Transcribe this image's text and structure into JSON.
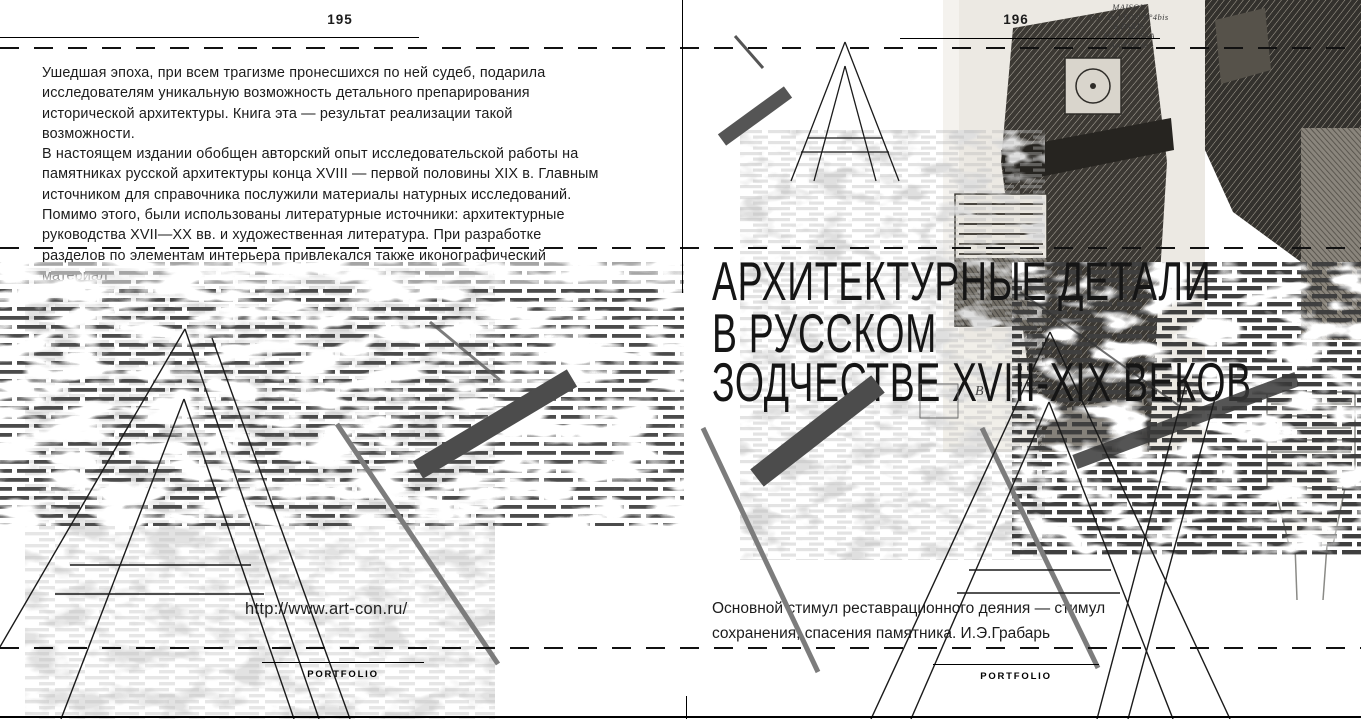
{
  "spread": {
    "left_page": {
      "page_number": "195",
      "paragraph": "Ушедшая эпоха, при всем трагизме пронесшихся по ней судеб, подарила\nисследователям уникальную возможность детального препарирования\nисторической архитектуры. Книга эта — результат реализации такой\nвозможности.\nВ настоящем издании обобщен авторский опыт исследовательской работы на\nпамятниках русской архитектуры конца XVIII — первой половины XIX в. Главным\nисточником для справочника послужили материалы натурных исследований.\nПомимо этого, были использованы литературные источники: архитектурные\nруководства XVII—XX вв. и художественная литература. При разработке\nразделов по элементам интерьера привлекался также иконографический\nматериал",
      "url": "http://www.art-con.ru/",
      "footer": "PORTFOLIO"
    },
    "right_page": {
      "page_number": "196",
      "title_line1": "АРХИТЕКТУРНЫЕ ДЕТАЛИ",
      "title_line2": "В РУССКОМ",
      "title_line3": "ЗОДЧЕСТВЕ XVIII-XIX ВЕКОВ",
      "quote": "Основной стимул реставрационного деяния — стимул\nсохранения, спасения памятника. И.Э.Грабарь",
      "footer": "PORTFOLIO",
      "engraving_caption": {
        "lines": [
          "MAISON",
          "Rue de LYON N°4bis",
          "à PARIS",
          "M. G. MASSA",
          "- Architecte -"
        ]
      },
      "engraving_annotation": "В"
    },
    "colors": {
      "page_bg": "#ffffff",
      "ink": "#1a1a1a",
      "brick_dark": "#4b4b4b",
      "brick_light": "#c3c3c3",
      "bar_gray": "#4c4c4c",
      "line_gray": "#7c7c7c",
      "engraving_bg": "#ece9e3"
    }
  }
}
